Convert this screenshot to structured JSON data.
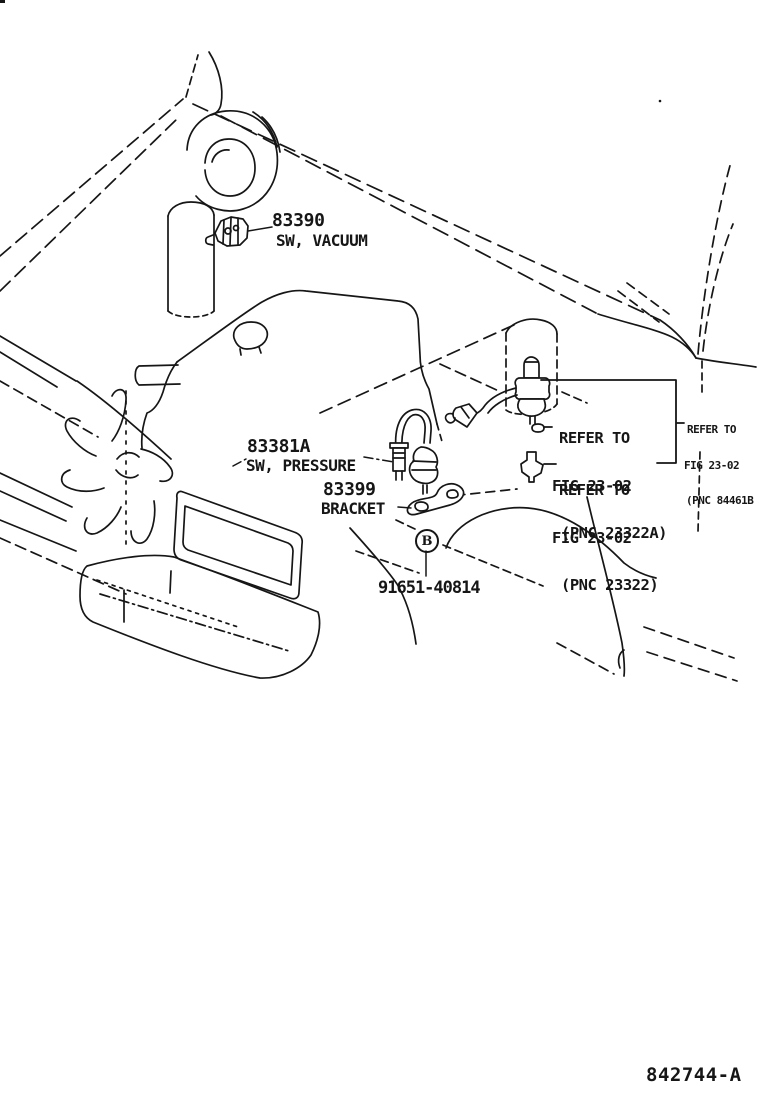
{
  "page": {
    "background": "#ffffff",
    "ink": "#161616"
  },
  "diagram": {
    "figure_code": "842744-A",
    "marker_b": "B",
    "labels": {
      "sw_vacuum": {
        "part_no": "83390",
        "part_name": "SW, VACUUM"
      },
      "sw_pressure": {
        "part_no": "83381A",
        "part_name": "SW, PRESSURE"
      },
      "bracket": {
        "part_no": "83399",
        "part_name": "BRACKET"
      },
      "bolt": {
        "part_no": "91651-40814"
      }
    },
    "references": [
      {
        "line1": "REFER TO",
        "line2": "FIG 23-02",
        "line3": "(PNC 23322A)"
      },
      {
        "line1": "REFER TO",
        "line2": "FIG 23-02",
        "line3": "(PNC 23322)"
      },
      {
        "line1": "REFER TO",
        "line2": "FIG 23-02",
        "line3": "(PNC 84461B"
      }
    ]
  }
}
